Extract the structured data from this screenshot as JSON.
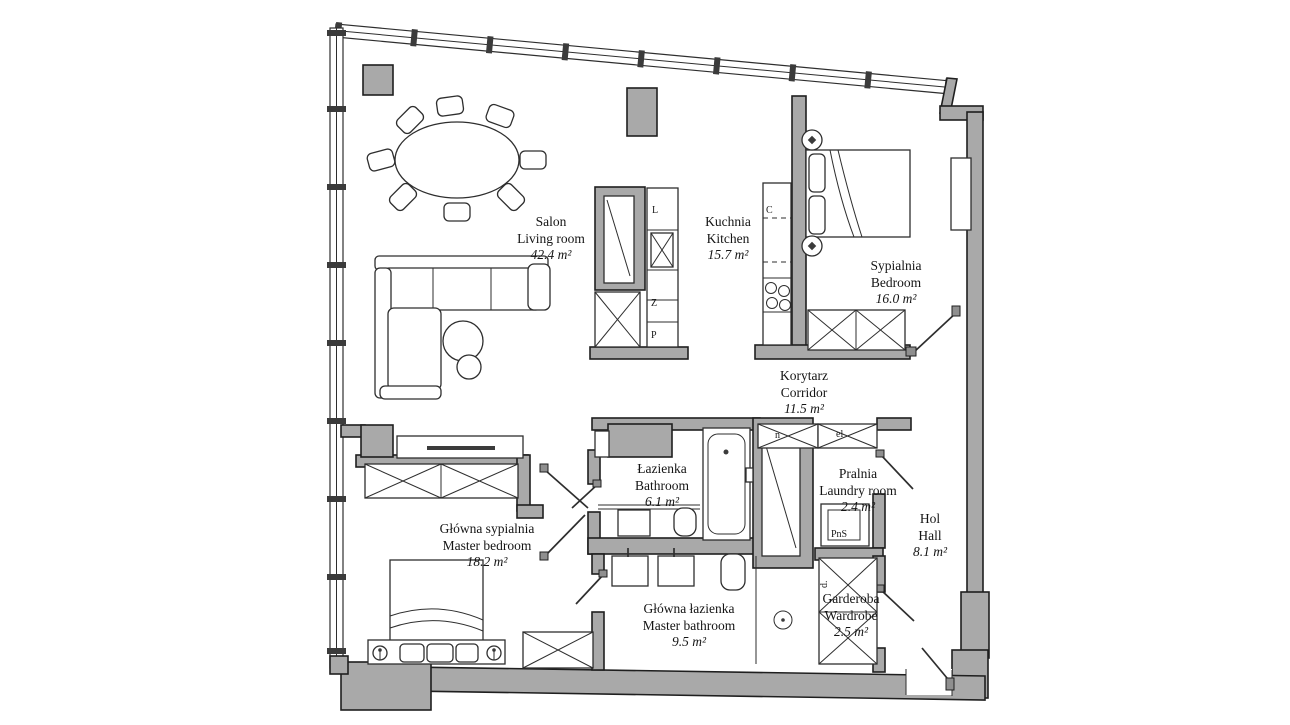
{
  "plan": {
    "background": "#ffffff",
    "wall_color": "#a9a9a9",
    "line_color": "#1f1f1f"
  },
  "rooms": [
    {
      "id": "salon",
      "name_pl": "Salon",
      "name_en": "Living room",
      "area": "42.4 m²"
    },
    {
      "id": "kuchnia",
      "name_pl": "Kuchnia",
      "name_en": "Kitchen",
      "area": "15.7 m²"
    },
    {
      "id": "sypialnia",
      "name_pl": "Sypialnia",
      "name_en": "Bedroom",
      "area": "16.0 m²"
    },
    {
      "id": "korytarz",
      "name_pl": "Korytarz",
      "name_en": "Corridor",
      "area": "11.5 m²"
    },
    {
      "id": "lazienka",
      "name_pl": "Łazienka",
      "name_en": "Bathroom",
      "area": "6.1 m²"
    },
    {
      "id": "pralnia",
      "name_pl": "Pralnia",
      "name_en": "Laundry room",
      "area": "2.4 m²"
    },
    {
      "id": "hol",
      "name_pl": "Hol",
      "name_en": "Hall",
      "area": "8.1 m²"
    },
    {
      "id": "glowna-sypialnia",
      "name_pl": "Główna sypialnia",
      "name_en": "Master bedroom",
      "area": "18.2 m²"
    },
    {
      "id": "glowna-lazienka",
      "name_pl": "Główna łazienka",
      "name_en": "Master bathroom",
      "area": "9.5 m²"
    },
    {
      "id": "garderoba",
      "name_pl": "Garderoba",
      "name_en": "Wardrobe",
      "area": "2.5 m²"
    }
  ],
  "fixtures": {
    "fridge": "L",
    "dishwasher": "Z",
    "oven": "P",
    "cooker": "C",
    "niche": "n",
    "electrical": "el",
    "washer": "PnS",
    "duct": "d."
  }
}
